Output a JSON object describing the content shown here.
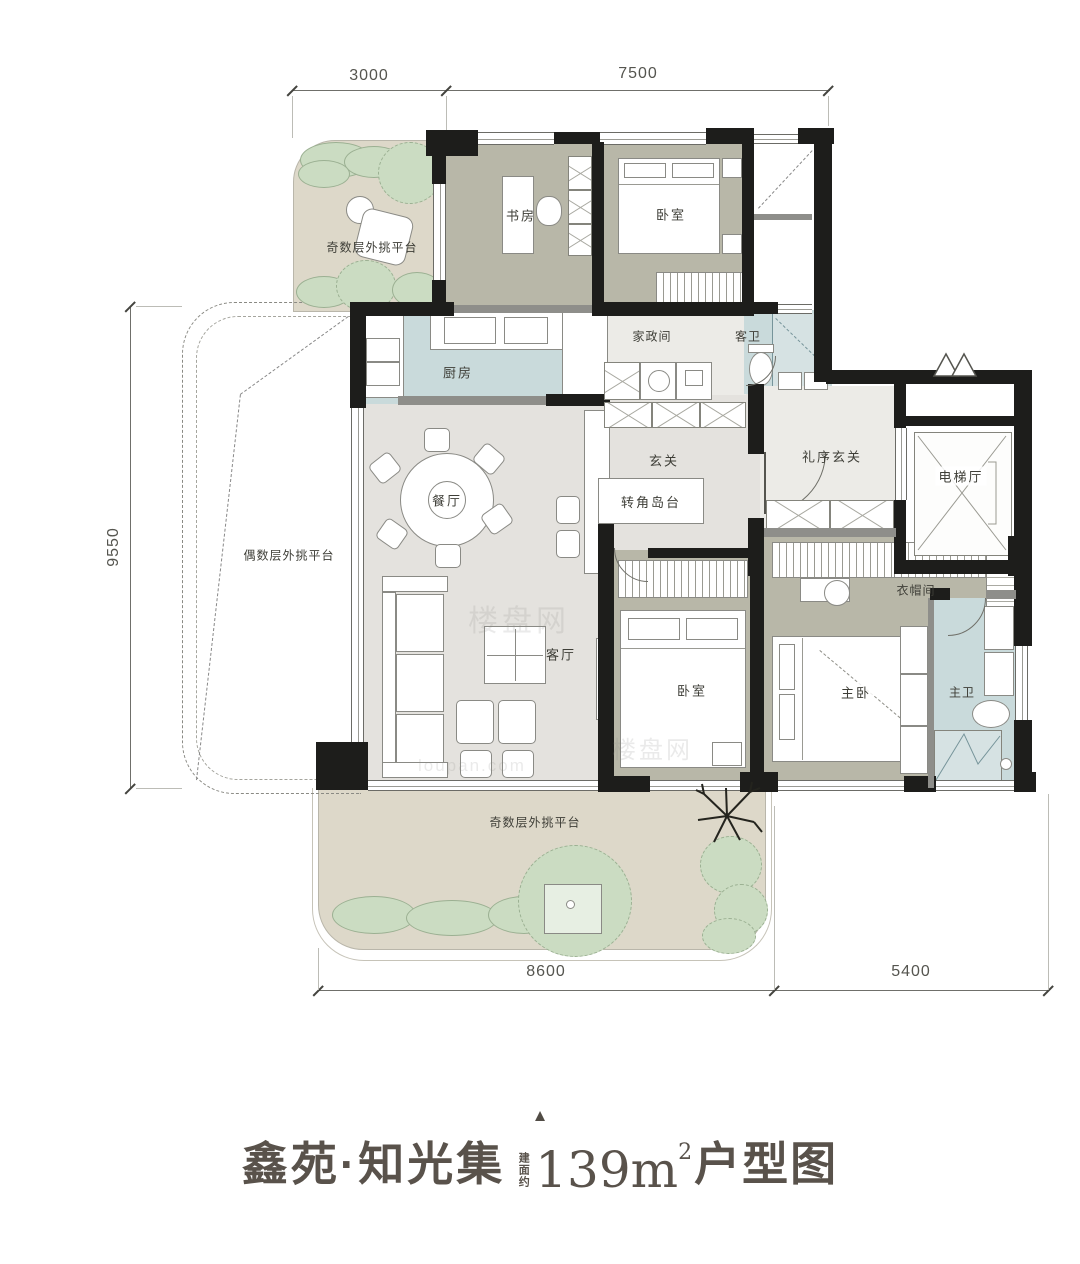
{
  "title": {
    "pointer": "▲",
    "project": "鑫苑·知光集",
    "area_prefix": "建面约",
    "area_number": "139m",
    "area_sup": "2",
    "suffix": "户型图"
  },
  "dimensions": {
    "top_left": "3000",
    "top_right": "7500",
    "left": "9550",
    "bottom_left": "8600",
    "bottom_right": "5400"
  },
  "rooms": {
    "platform_top": {
      "label": "奇数层外挑平台"
    },
    "study": {
      "label": "书房"
    },
    "bedroom_top": {
      "label": "卧室"
    },
    "housekeeping": {
      "label": "家政间"
    },
    "guest_bath": {
      "label": "客卫"
    },
    "kitchen": {
      "label": "厨房"
    },
    "foyer": {
      "label": "玄关"
    },
    "ceremony_foyer": {
      "label": "礼序玄关"
    },
    "elevator_hall": {
      "label": "电梯厅"
    },
    "dining": {
      "label": "餐厅"
    },
    "corner_island": {
      "label": "转角岛台"
    },
    "platform_left": {
      "label": "偶数层外挑平台"
    },
    "living": {
      "label": "客厅"
    },
    "bedroom_mid": {
      "label": "卧室"
    },
    "cloakroom": {
      "label": "衣帽间"
    },
    "master_bedroom": {
      "label": "主卧"
    },
    "master_bath": {
      "label": "主卫"
    },
    "platform_bottom": {
      "label": "奇数层外挑平台"
    }
  },
  "watermarks": {
    "cn": "楼盘网",
    "en": "loupan.com"
  },
  "colors": {
    "wall": "#1d1d1b",
    "taupe": "#b8b7a8",
    "blue": "#c9dadb",
    "gray-floor": "#e4e2de",
    "light-floor": "#ecebe7",
    "beige": "#ddd8c9",
    "green": "#cbdcc2",
    "green-line": "#9bb092",
    "title": "#59524b",
    "furn-line": "#8a8a85"
  }
}
